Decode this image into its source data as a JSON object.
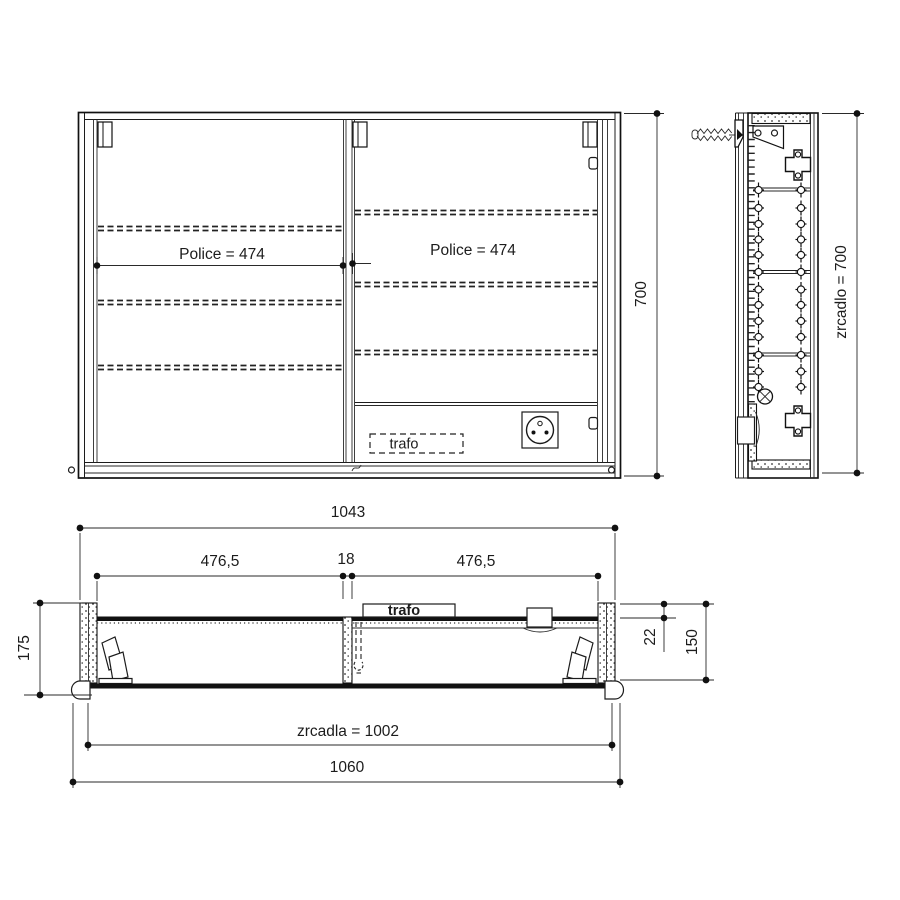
{
  "drawing_title": "mirror cabinet technical drawing",
  "colors": {
    "line": "#1c1c1c",
    "background": "#ffffff"
  },
  "front_view": {
    "police_left": "Police = 474",
    "police_right": "Police = 474",
    "trafo_label": "trafo",
    "height_dim": "700"
  },
  "side_view": {
    "mirror_height_dim": "zrcadlo = 700"
  },
  "plan_view": {
    "inner_width_dim": "1043",
    "left_shelf_dim": "476,5",
    "divider_dim": "18",
    "right_shelf_dim": "476,5",
    "trafo_label": "trafo",
    "front_offset_dim": "22",
    "depth_dim": "150",
    "total_depth_dim": "175",
    "mirror_width_dim": "zrcadla = 1002",
    "total_width_dim": "1060"
  }
}
